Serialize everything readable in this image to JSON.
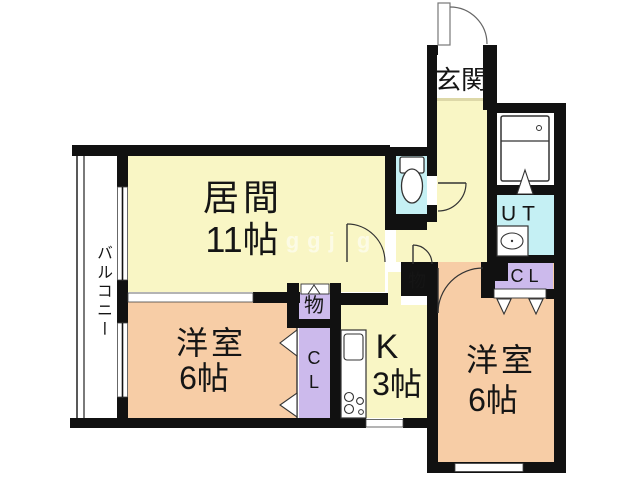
{
  "title": "apartment floor plan",
  "colors": {
    "wall": "#111111",
    "floor_yellow": "#f9f6c5",
    "floor_peach": "#f7cda6",
    "floor_cyan": "#c5f0f4",
    "floor_lavender": "#ccbaec"
  },
  "rooms": {
    "living": {
      "name": "居間",
      "size": "11帖"
    },
    "bedroom_left": {
      "name": "洋室",
      "size": "6帖"
    },
    "bedroom_right": {
      "name": "洋室",
      "size": "6帖"
    },
    "kitchen": {
      "name": "K",
      "size": "3帖"
    },
    "entrance": {
      "name": "玄関"
    },
    "balcony": {
      "name": "バルコニー"
    },
    "utility": {
      "name": "UT"
    },
    "closet_left": {
      "name": "CL"
    },
    "closet_right": {
      "name": "CL"
    },
    "storage_left": {
      "name": "物"
    },
    "storage_right": {
      "name": "物"
    }
  },
  "watermark": "ggj g"
}
